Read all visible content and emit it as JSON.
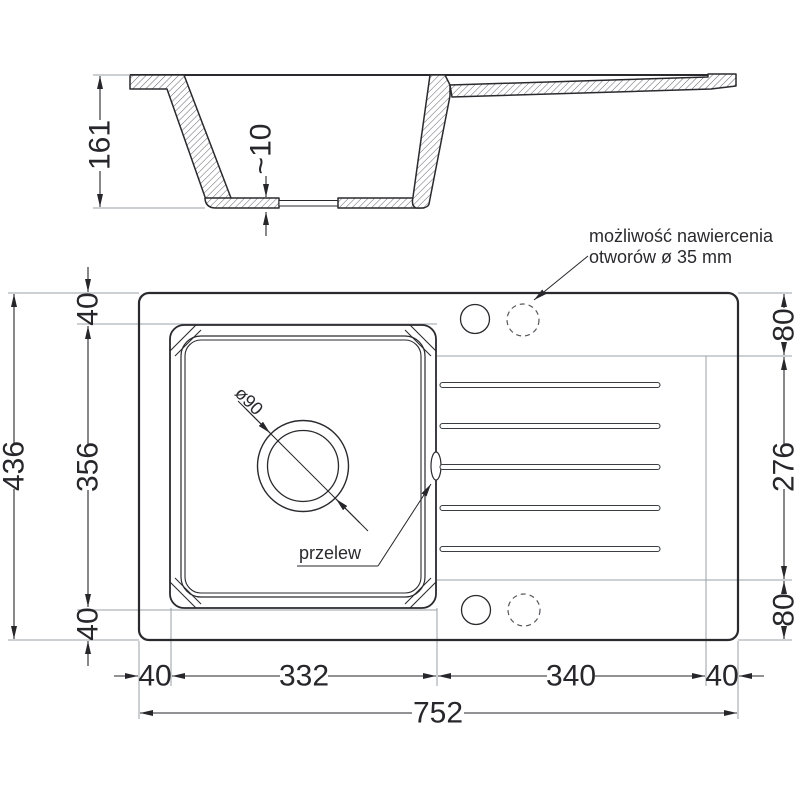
{
  "annotation": {
    "drill_note_line1": "możliwość nawiercenia",
    "drill_note_line2": "otworów ø 35 mm"
  },
  "section": {
    "depth": "161",
    "base_thickness": "~10"
  },
  "plan": {
    "height_total": "436",
    "left_margin_top": "40",
    "bowl_height": "356",
    "left_margin_bottom": "40",
    "right_margin_top": "80",
    "drainer_height": "276",
    "right_margin_bottom": "80",
    "bottom_margin_left": "40",
    "bowl_width": "332",
    "drainer_width": "340",
    "bottom_margin_right": "40",
    "width_total": "752"
  },
  "labels": {
    "overflow": "przelew",
    "drain_diameter": "ø90"
  },
  "colors": {
    "line": "#2a2a2e",
    "dimension": "#26262b",
    "construction": "#9aa0a6",
    "background": "#ffffff"
  }
}
